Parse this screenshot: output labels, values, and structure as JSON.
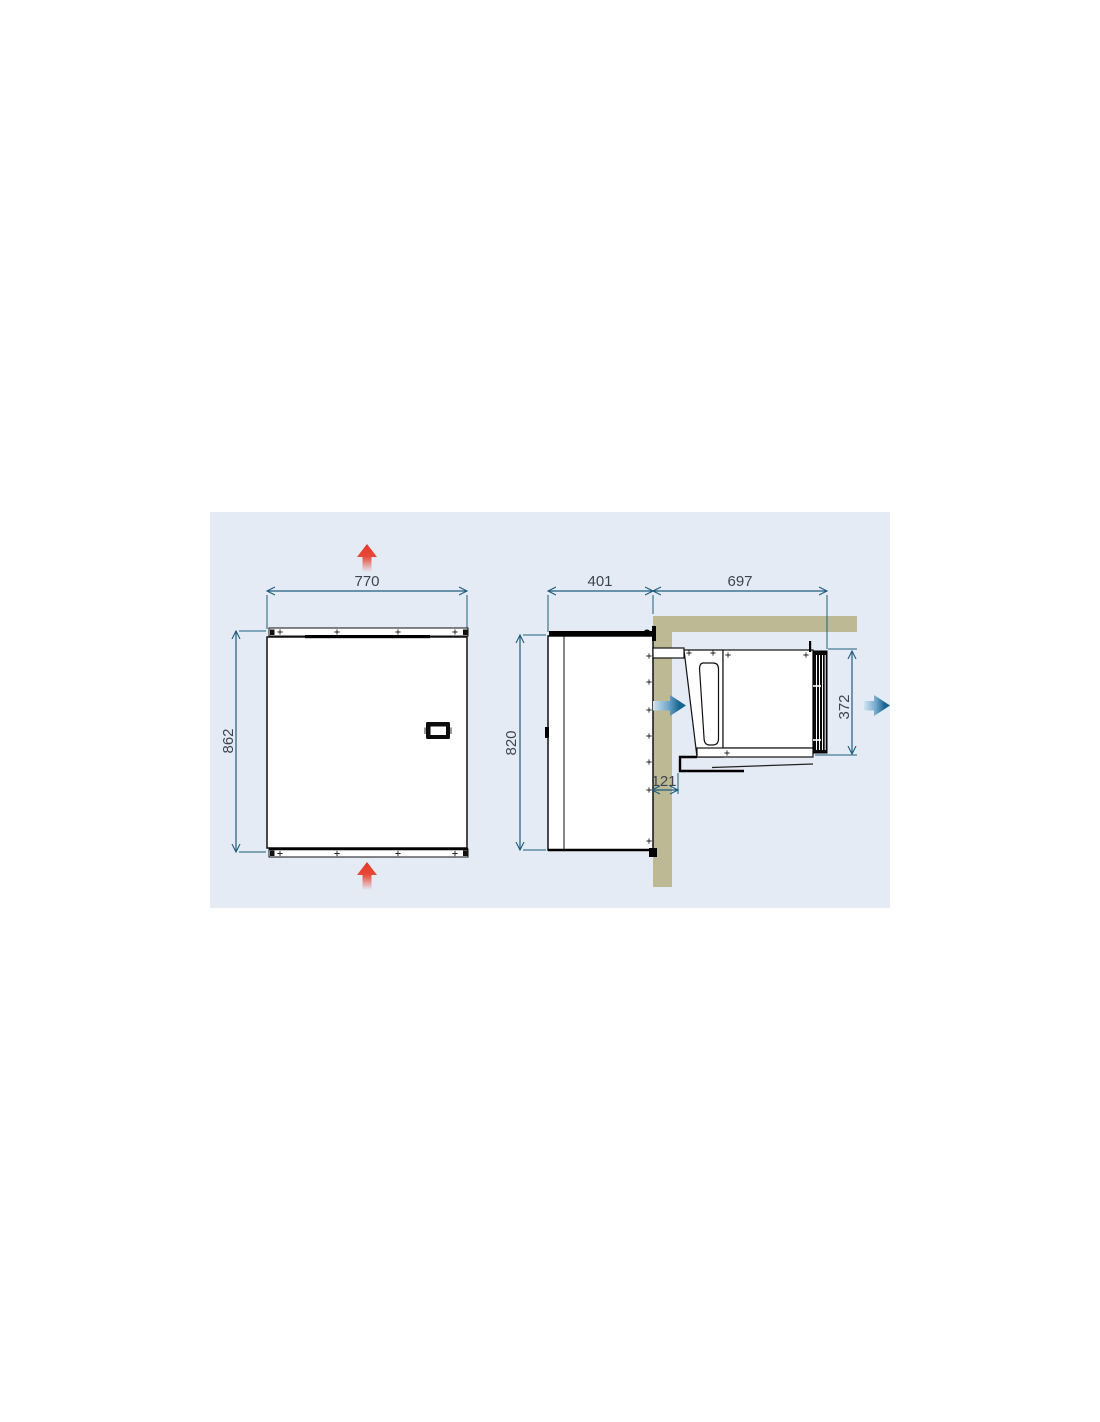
{
  "figure": {
    "title": "monoblock-refrigeration-unit-dimensional-drawing",
    "panel_bg": "#e4ebf4",
    "colors": {
      "wall": "#bdb995",
      "dim_line": "#1e5c7d",
      "dim_text": "#3b454e",
      "red_arrow": "#e5382a",
      "blue_arrow_dark": "#16648f",
      "blue_arrow_light": "#d3e4f0",
      "linework": "#111111"
    },
    "icons": [
      "airflow-up-arrow",
      "airflow-up-arrow",
      "airflow-in-arrow",
      "airflow-out-arrow"
    ],
    "dims": {
      "front_width": "770",
      "front_height": "862",
      "side_depth": "401",
      "side_protrusion": "697",
      "side_height": "820",
      "condenser_height": "372",
      "bottom_offset": "121"
    }
  }
}
